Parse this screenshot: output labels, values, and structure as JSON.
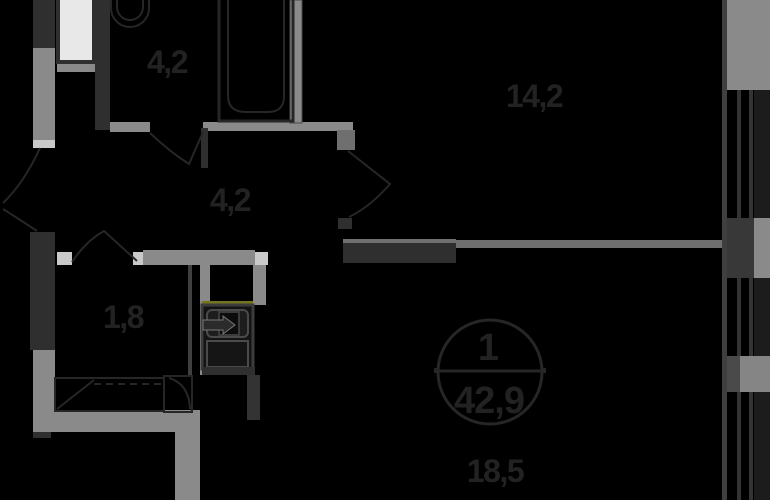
{
  "plan": {
    "unit_circle": {
      "number": "1",
      "total_area": "42,9"
    },
    "rooms": [
      {
        "name": "bathroom",
        "area": "4,2"
      },
      {
        "name": "living-room",
        "area": "14,2"
      },
      {
        "name": "hallway",
        "area": "4,2"
      },
      {
        "name": "wardrobe",
        "area": "1,8"
      },
      {
        "name": "main-room",
        "area": "18,5"
      }
    ],
    "symbols": {
      "shaft_arrow_icon": "arrow-right-into-box",
      "doors": "quarter-circle-swing",
      "windows": "double-glazing-lines"
    },
    "colors": {
      "bg": "#000000",
      "wall-gray": "#8a8a8a",
      "wall-gray2": "#6f6f6f",
      "wall-dark": "#2f2f2f",
      "jamb-light": "#c9c9c9",
      "line": "#262626",
      "glass": "#1c1c1c",
      "text": "#222222",
      "leaf": "#e8e8e8",
      "accent": "#74741f"
    }
  }
}
